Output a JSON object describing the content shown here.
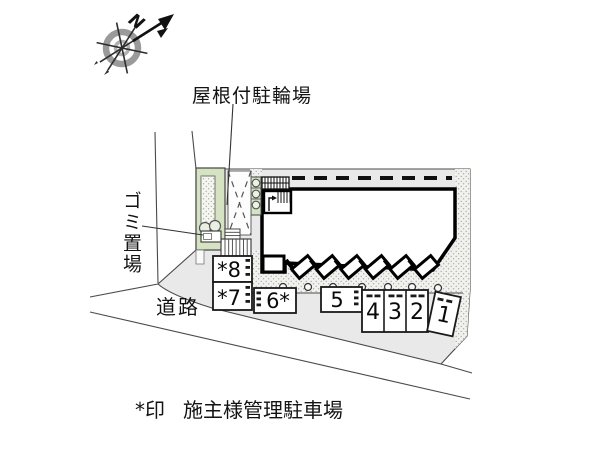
{
  "compass": {
    "north_label": "N"
  },
  "labels": {
    "covered_bicycle_parking": "屋根付駐輪場",
    "garbage_area": "ゴミ置場",
    "road": "道路"
  },
  "legend": {
    "mark": "*印",
    "text": "施主様管理駐車場"
  },
  "parking_spaces": [
    {
      "label": "*8"
    },
    {
      "label": "*7"
    },
    {
      "label": "6*"
    },
    {
      "label": "5"
    },
    {
      "label": "4"
    },
    {
      "label": "3"
    },
    {
      "label": "2"
    },
    {
      "label": "1"
    }
  ],
  "colors": {
    "site_fill": "#e9e9e9",
    "stipple_fill": "#f1f1ee",
    "stipple_dot": "#a8a8a8",
    "greenery_fill": "#d5e3c3",
    "building_fill": "#ffffff",
    "outline": "#000000"
  }
}
